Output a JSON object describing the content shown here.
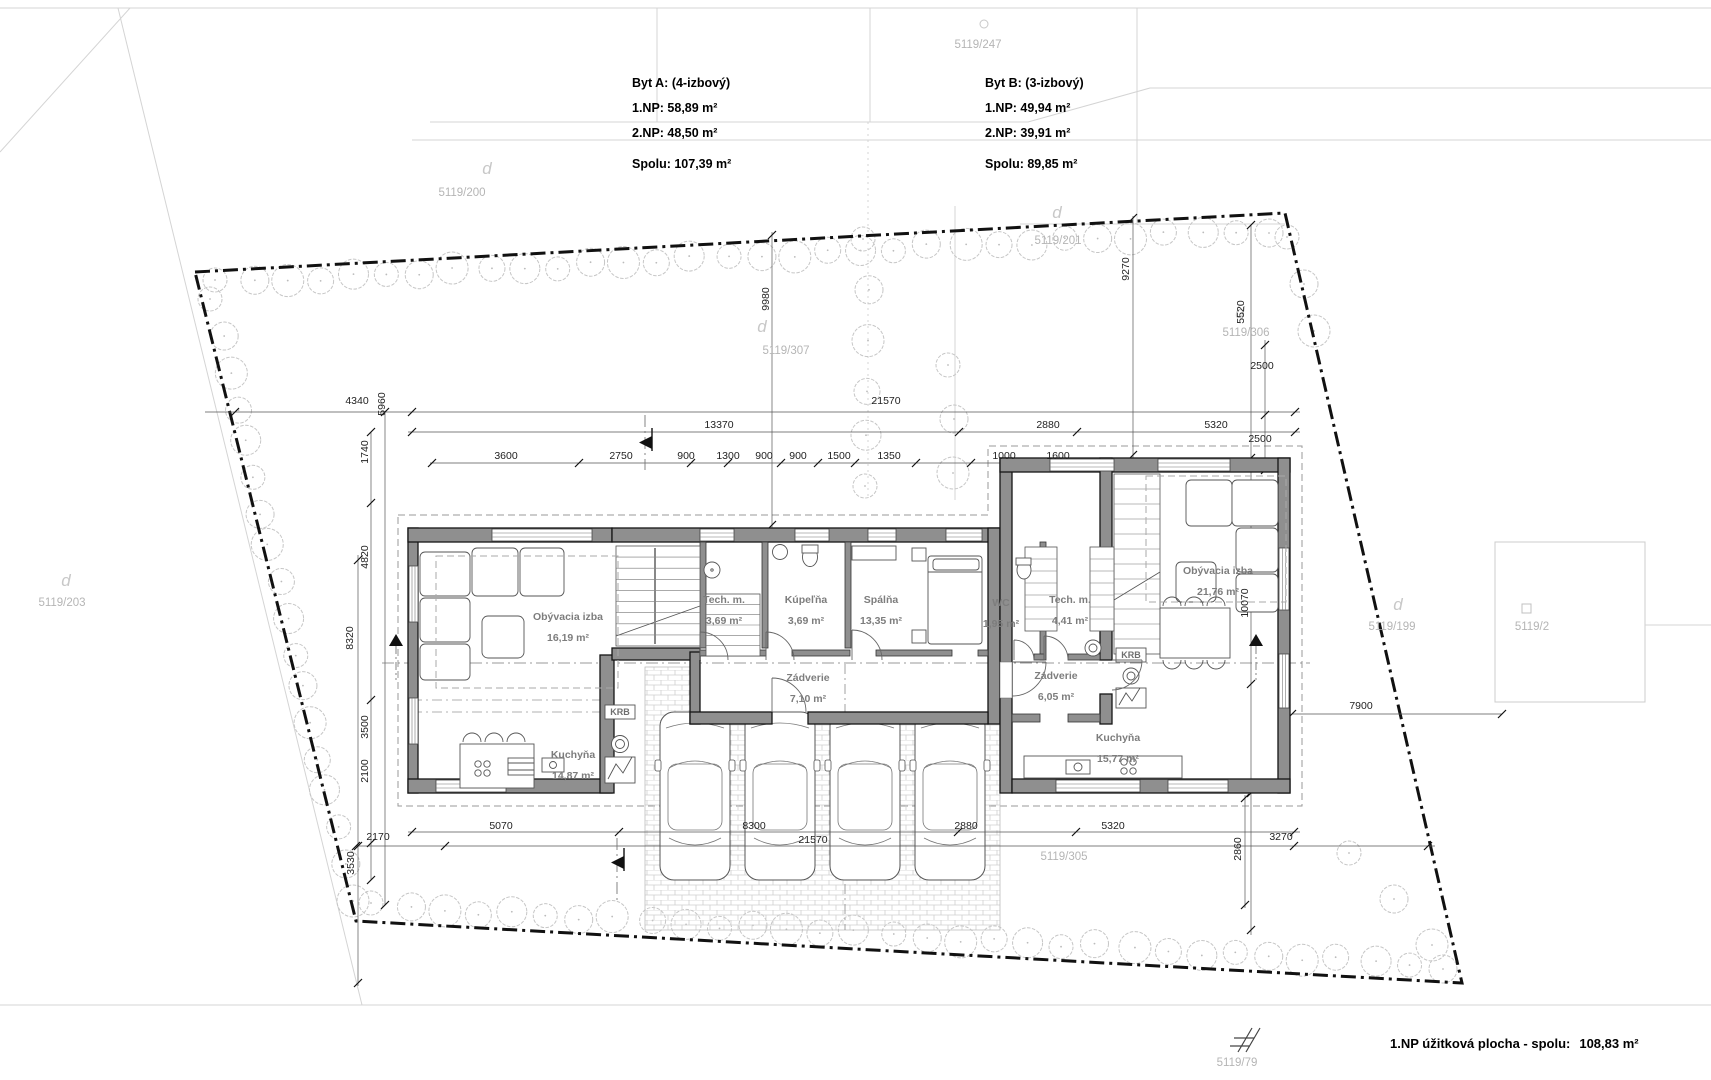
{
  "title_blocks": {
    "byt_a": {
      "name": "Byt A: (4-izbový)",
      "np1": "1.NP: 58,89 m²",
      "np2": "2.NP: 48,50 m²",
      "total": "Spolu: 107,39 m²"
    },
    "byt_b": {
      "name": "Byt B: (3-izbový)",
      "np1": "1.NP: 49,94 m²",
      "np2": "2.NP: 39,91 m²",
      "total": "Spolu: 89,85 m²"
    }
  },
  "summary": {
    "label": "1.NP úžitková plocha - spolu:",
    "value": "108,83 m²"
  },
  "parcels": [
    "5119/247",
    "5119/200",
    "5119/201",
    "5119/306",
    "5119/307",
    "5119/203",
    "5119/199",
    "5119/2",
    "5119/305",
    "5119/79"
  ],
  "glyph_d": "d",
  "rooms": [
    {
      "n": "Obývacia izba",
      "a": "16,19 m²"
    },
    {
      "n": "Tech. m.",
      "a": "3,69 m²"
    },
    {
      "n": "Kúpeľňa",
      "a": "3,69 m²"
    },
    {
      "n": "Spálňa",
      "a": "13,35 m²"
    },
    {
      "n": "WC",
      "a": "1,95 m²"
    },
    {
      "n": "Tech. m.",
      "a": "4,41 m²"
    },
    {
      "n": "Obývacia izba",
      "a": "21,76 m²"
    },
    {
      "n": "Zádverie",
      "a": "7,10 m²"
    },
    {
      "n": "Zádverie",
      "a": "6,05 m²"
    },
    {
      "n": "Kuchyňa",
      "a": "14,87 m²"
    },
    {
      "n": "Kuchyňa",
      "a": "15,77 m²"
    }
  ],
  "fireplace": {
    "a": "KRB",
    "b": "KRB"
  },
  "dims": {
    "h": [
      "4340",
      "21570",
      "13370",
      "2880",
      "5320",
      "3600",
      "2750",
      "900",
      "1300",
      "900",
      "900",
      "1500",
      "1350",
      "1000",
      "1600",
      "2500",
      "2500",
      "7900",
      "5070",
      "8300",
      "2880",
      "5320",
      "2170",
      "21570",
      "3270"
    ],
    "v": [
      "5960",
      "9980",
      "9270",
      "5520",
      "1740",
      "4820",
      "8320",
      "3500",
      "2100",
      "3530",
      "10070",
      "2860"
    ]
  },
  "colors": {
    "wall": "#8f8f8f",
    "boundary": "#111111",
    "parcel_text": "#b5b5b5",
    "room_text": "#7d7d7d"
  }
}
